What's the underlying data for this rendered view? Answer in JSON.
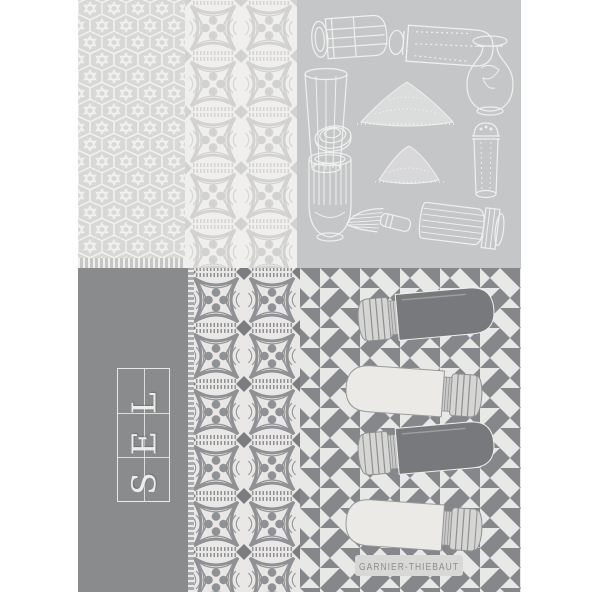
{
  "towel": {
    "sel_label": "SEL",
    "brand_label": "GARNIER-THIEBAUT"
  },
  "sections": {
    "top_left": "hexagon-weave-pattern",
    "top_middle": "tile-medallion-column-light",
    "top_right": "salt-shaker-illustrations",
    "bottom_left": "sel-title-panel",
    "bottom_middle": "tile-medallion-column-dark",
    "bottom_right": "pinwheel-pattern-with-shakers"
  },
  "icons": {
    "salt-mill-lying": "svg-line-art",
    "salt-shaker-lying": "svg-line-art",
    "glass-carafe-shaker": "svg-line-art",
    "faceted-glass": "svg-line-art",
    "salt-pile-large": "svg-line-art",
    "round-salt-box": "svg-line-art",
    "ribbed-shaker": "svg-line-art",
    "salt-pile-small": "svg-line-art",
    "tall-shaker": "svg-line-art",
    "salt-whisk": "svg-line-art",
    "ridged-shaker-lying": "svg-line-art",
    "salt-shaker-dark-silhouette": "svg-shape",
    "salt-shaker-light-silhouette": "svg-shape"
  },
  "colors": {
    "page_bg": "#ffffff",
    "hex_pattern_bg": "#d8d9d7",
    "hex_pattern_line": "#f2f2f0",
    "tile_light_bg": "#f0efed",
    "tile_light_motif": "#d2d3d1",
    "tile_dark_bg": "#e9e8e6",
    "tile_dark_motif": "#8f9194",
    "tile_dark_accent": "#7a7c7f",
    "illustration_panel_bg": "#c5c6c8",
    "illustration_stroke": "#f5f5f3",
    "sel_panel_bg": "#898b8d",
    "sel_text": "#edeeec",
    "pinwheel_bg": "#e8e8e6",
    "pinwheel_gray": "#85878a",
    "shaker_dark": "#77797c",
    "shaker_light": "#eceae7",
    "brand_badge_bg": "#d8d8d6",
    "brand_text": "#8b8d8f"
  }
}
